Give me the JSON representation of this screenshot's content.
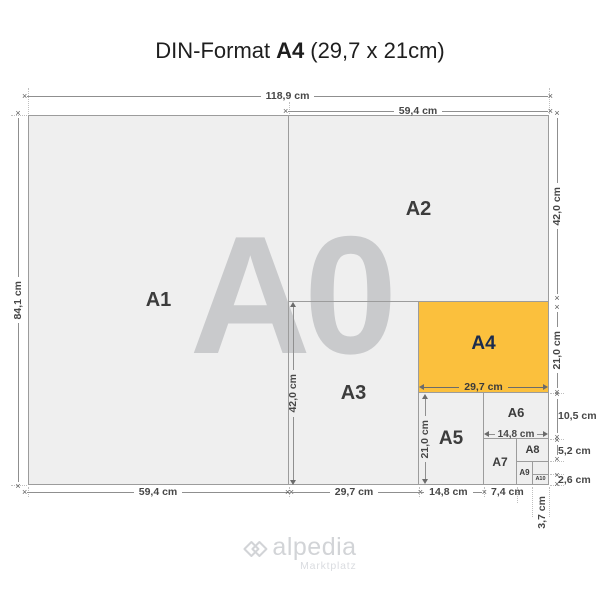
{
  "title": {
    "prefix": "DIN-Format",
    "bold": "A4",
    "suffix": "(29,7 x 21cm)"
  },
  "watermark": "A0",
  "formats": {
    "a1": "A1",
    "a2": "A2",
    "a3": "A3",
    "a4": "A4",
    "a5": "A5",
    "a6": "A6",
    "a7": "A7",
    "a8": "A8",
    "a9": "A9",
    "a10": "A10"
  },
  "dims": {
    "top_full": "118,9 cm",
    "top_right": "59,4 cm",
    "left": "84,1 cm",
    "right_a2": "42,0 cm",
    "right_a4": "21,0 cm",
    "right_a6": "10,5 cm",
    "right_a8": "5,2 cm",
    "right_a10": "2,6 cm",
    "bottom_a1": "59,4 cm",
    "bottom_a3": "29,7 cm",
    "bottom_a5": "14,8 cm",
    "bottom_a7": "7,4 cm",
    "bottom_a10_w": "3,7 cm",
    "inner_a3_h": "42,0 cm",
    "inner_a4_w": "29,7 cm",
    "inner_a5_h": "21,0 cm",
    "inner_a6_w": "14,8 cm"
  },
  "logo": {
    "name": "alpedia",
    "tagline": "Marktplatz"
  },
  "colors": {
    "highlight": "#FBC03D",
    "highlight_text": "#1B2B4D",
    "paper": "#EFEFEF",
    "paper_border": "#9C9C9C",
    "watermark_gray": "#C9CACC",
    "dim_text": "#474747",
    "logo_gray": "#D2D4D7"
  }
}
